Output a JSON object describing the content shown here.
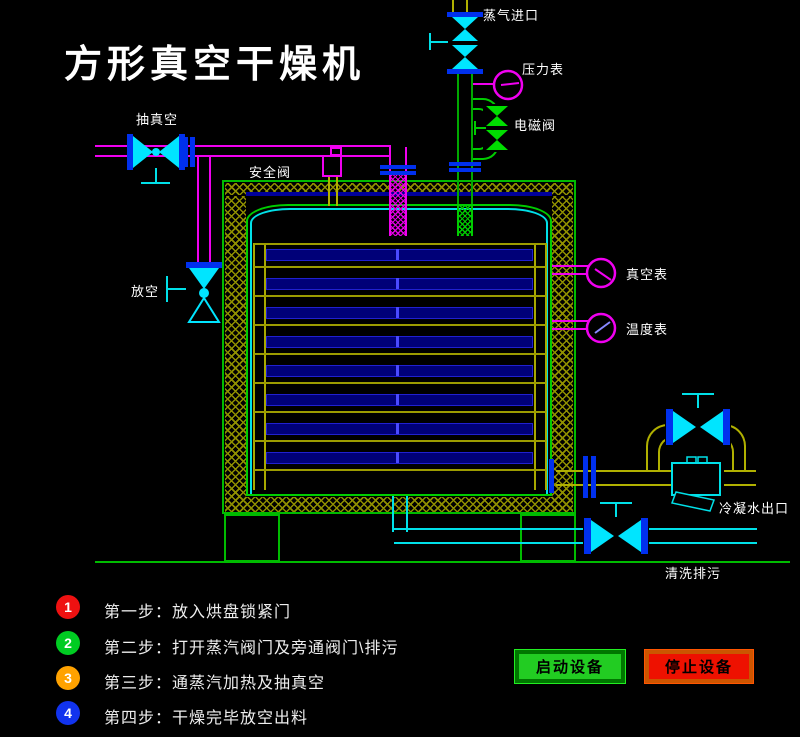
{
  "title": "方形真空干燥机",
  "labels": {
    "steam_inlet": "蒸气进口",
    "pressure_gauge": "压力表",
    "solenoid_valve": "电磁阀",
    "vacuum_line": "抽真空",
    "safety_valve": "安全阀",
    "vent": "放空",
    "vacuum_gauge": "真空表",
    "temp_gauge": "温度表",
    "condensate_outlet": "冷凝水出口",
    "flush_drain": "清洗排污"
  },
  "steps": [
    {
      "num": "1",
      "text": "第一步：放入烘盘锁紧门",
      "color": "#ee1111"
    },
    {
      "num": "2",
      "text": "第二步：打开蒸汽阀门及旁通阀门\\排污",
      "color": "#00cc22"
    },
    {
      "num": "3",
      "text": "第三步：通蒸汽加热及抽真空",
      "color": "#ffa200"
    },
    {
      "num": "4",
      "text": "第四步：干燥完毕放空出料",
      "color": "#1133ee"
    }
  ],
  "buttons": {
    "start": {
      "label": "启动设备",
      "color": "#22cc22"
    },
    "stop": {
      "label": "停止设备",
      "color": "#ee1100"
    }
  },
  "colors": {
    "background": "#000000",
    "pipe_vacuum": "#f000f0",
    "pipe_water": "#00e0e8",
    "pipe_steam": "#00a800",
    "pipe_condensate": "#b0b000",
    "vessel_outline": "#00bb00",
    "insulation_hatch": "#8f8f00",
    "flange": "#0030ee",
    "tray_fill": "#000078",
    "text": "#ffffff"
  }
}
